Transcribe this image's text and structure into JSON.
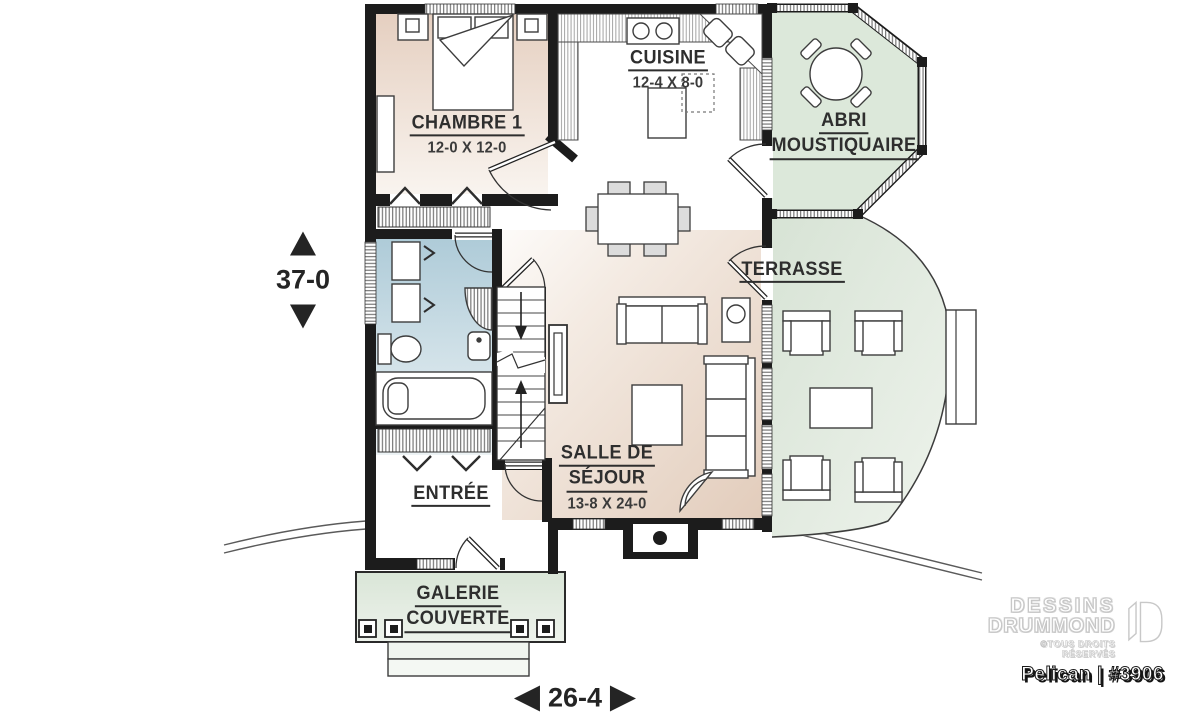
{
  "plan": {
    "rooms": {
      "chambre1": {
        "name": "CHAMBRE 1",
        "dims": "12-0 X 12-0"
      },
      "cuisine": {
        "name": "CUISINE",
        "dims": "12-4 X 8-0"
      },
      "abri": {
        "line1": "ABRI",
        "line2": "MOUSTIQUAIRE"
      },
      "terrasse": {
        "name": "TERRASSE"
      },
      "sejour": {
        "line1": "SALLE DE",
        "line2": "SÉJOUR",
        "dims": "13-8 X 24-0"
      },
      "entree": {
        "name": "ENTRÉE"
      },
      "galerie": {
        "line1": "GALERIE",
        "line2": "COUVERTE"
      }
    },
    "dimensions": {
      "depth": "37-0",
      "width": "26-4"
    },
    "branding": {
      "brand_line1": "DESSINS",
      "brand_line2": "DRUMMOND",
      "copyright": "©TOUS DROITS RÉSERVÉS",
      "plan_id": "Pelican | #3906"
    },
    "colors": {
      "wall": "#1c1c1c",
      "floor_beige": "#e6d1c1",
      "bath_blue": "#b3cdd9",
      "outdoor_green": "#dbe7d9",
      "label_text": "#2e2e2e"
    }
  }
}
